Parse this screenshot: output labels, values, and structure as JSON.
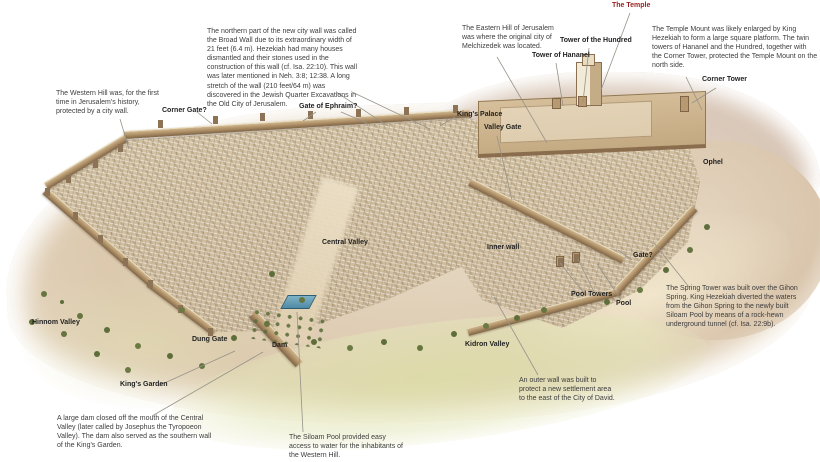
{
  "diagram": {
    "subject": "Annotated aerial illustration of Jerusalem with city walls, valleys, gates and towers"
  },
  "colors": {
    "background": "#ffffff",
    "label_text": "#1f1f1f",
    "temple_label_red": "#9c2121",
    "note_text": "#3d3d3d",
    "leader_line": "#979289",
    "hill": "#dcc9ae",
    "wall": "#a98a62",
    "city_texture": "#d8c8a9",
    "pool_water": "#4f8aa4",
    "tree_green": "#5d6e3b"
  },
  "notes": {
    "western_hill": "The Western Hill was, for the first time in Jerusalem's history, protected by a city wall.",
    "broad_wall": "The northern part of the new city wall was called the Broad Wall due to its extraordinary width of 21 feet (6.4 m). Hezekiah had many houses dismantled and their stones used in the construction of this wall (cf. Isa. 22:10). This wall was later mentioned in Neh. 3:8; 12:38. A long stretch of the wall (210 feet/64 m) was discovered in the Jewish Quarter Excavations in the Old City of Jerusalem.",
    "eastern_hill": "The Eastern Hill of Jerusalem was where the original city of Melchizedek was located.",
    "temple_mount": "The Temple Mount was likely enlarged by King Hezekiah to form a large square platform. The twin towers of Hananel and the Hundred, together with the Corner Tower, protected the Temple Mount on the north side.",
    "spring_tower": "The Spring Tower was built over the Gihon Spring. King Hezekiah diverted the waters from the Gihon Spring to the newly built Siloam Pool by means of a rock-hewn underground tunnel (cf. Isa. 22:9b).",
    "outer_wall": "An outer wall was built to protect a new settlement area to the east of the City of David.",
    "siloam_pool": "The Siloam Pool provided easy access to water for the inhabitants of the Western Hill.",
    "large_dam": "A large dam closed off the mouth of the Central Valley (later called by Josephus the Tyropoeon Valley). The dam also served as the southern wall of the King's Garden."
  },
  "labels": {
    "temple": "The Temple",
    "tower_hundred": "Tower of the Hundred",
    "tower_hananel": "Tower of Hananel",
    "corner_tower": "Corner Tower",
    "corner_gate": "Corner Gate?",
    "gate_of_ephraim": "Gate of Ephraim?",
    "kings_palace": "King's Palace",
    "valley_gate": "Valley Gate",
    "ophel": "Ophel",
    "central_valley": "Central Valley",
    "inner_wall": "Inner wall",
    "gate": "Gate?",
    "pool_towers": "Pool Towers",
    "pool": "Pool",
    "hinnom_valley": "Hinnom Valley",
    "dung_gate": "Dung Gate",
    "dam": "Dam",
    "kings_garden": "King's Garden",
    "kidron_valley": "Kidron Valley"
  }
}
